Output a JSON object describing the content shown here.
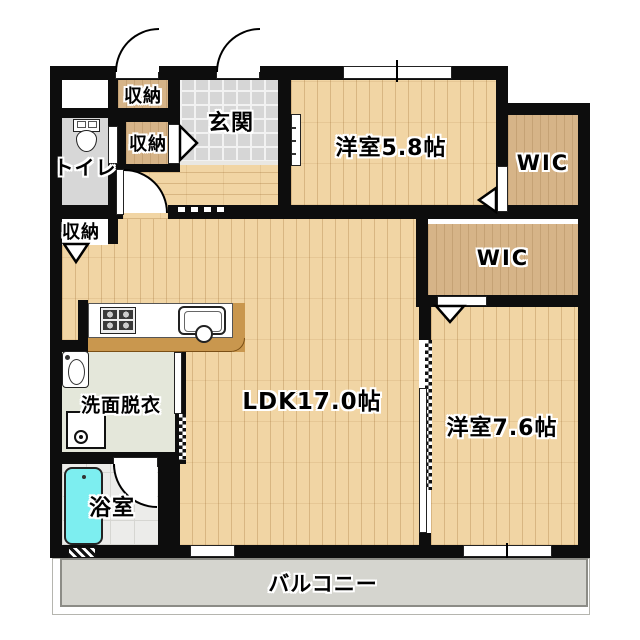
{
  "labels": {
    "storage_top": "収納",
    "storage_entrance": "収納",
    "storage_hall": "収納",
    "toilet": "トイレ",
    "entrance": "玄関",
    "western_room_5_8": "洋室5.8帖",
    "wic_upper": "WIC",
    "wic_lower": "WIC",
    "ldk": "LDK17.0帖",
    "western_room_7_6": "洋室7.6帖",
    "washroom": "洗面脱衣",
    "bathroom": "浴室",
    "balcony": "バルコニー"
  },
  "colors": {
    "wall": "#0d0d0d",
    "wood_floor": "#f1d5a4",
    "closet_wood": "#d6b488",
    "entrance_tile": "#d6d6d6",
    "toilet_floor": "#d7d7d7",
    "washroom_floor": "#e4e7da",
    "bath_floor": "#ececea",
    "bathtub": "#7deef0",
    "balcony": "#d5d5cf",
    "counter_trim": "#c9974e"
  }
}
